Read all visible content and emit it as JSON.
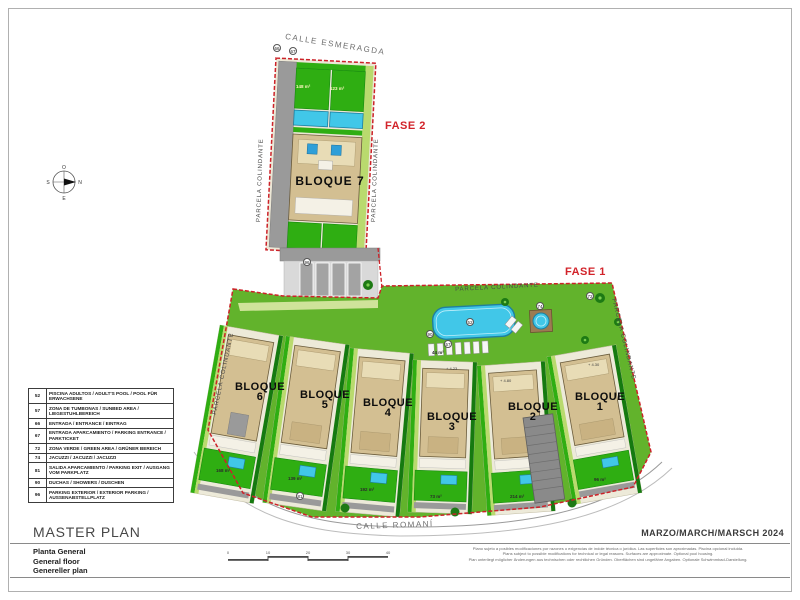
{
  "plan": {
    "streets": {
      "top": "CALLE ESMERAGDA",
      "bottom": "CALLE ROMANÍ"
    },
    "phases": {
      "fase1": "FASE 1",
      "fase2": "FASE 2"
    },
    "boundary_label": "PARCELA COLINDANTE",
    "compass": {
      "top": "O",
      "right": "N",
      "bottom": "E",
      "left": "S"
    },
    "bloques": {
      "b1": {
        "label": "BLOQUE",
        "num": "1"
      },
      "b2": {
        "label": "BLOQUE",
        "num": "2"
      },
      "b3": {
        "label": "BLOQUE",
        "num": "3"
      },
      "b4": {
        "label": "BLOQUE",
        "num": "4"
      },
      "b5": {
        "label": "BLOQUE",
        "num": "5"
      },
      "b6": {
        "label": "BLOQUE",
        "num": "6"
      },
      "b7": {
        "label": "BLOQUE 7"
      }
    },
    "areas": {
      "fase2_garden_left": "148 m²",
      "fase2_garden_right": "123 m²",
      "pool_terrace": "44 m²",
      "bloque6_garden": "168 m²",
      "bloque5_garden": "139 m²",
      "bloque4_garden": "192 m²",
      "bloque3_garden": "73 m²",
      "bloque2_garden": "214 m²",
      "bloque1_garden": "96 m²"
    },
    "levels": {
      "l1": "+ 4.23",
      "l2": "+ 4.80",
      "l3": "+ 4.30"
    },
    "markers": {
      "entrance": "66",
      "parking_entrance": "67",
      "exterior_parking": "96",
      "pool": "52",
      "sunbeds": "57",
      "showers": "90",
      "jacuzzi": "74",
      "green": "72",
      "parking_exit": "81"
    },
    "colors": {
      "boundary_red": "#cc2229",
      "lawn_green": "#62b32c",
      "garden_green": "#2fae12",
      "pool_blue": "#41c7e8",
      "building_beige": "#d3bf92"
    }
  },
  "legend": {
    "rows": [
      {
        "num": "52",
        "label": "PISCINA ADULTOS / ADULT'S POOL / POOL FÜR ERWACHSENE"
      },
      {
        "num": "57",
        "label": "ZONA DE TUMBONAS / SUNBED AREA / LIEGESTUHLBEREICH"
      },
      {
        "num": "66",
        "label": "ENTRADA / ENTRANCE / EINTRAG"
      },
      {
        "num": "67",
        "label": "ENTRADA APARCAMIENTO / PARKING ENTRANCE / PARKTICKET"
      },
      {
        "num": "72",
        "label": "ZONA VERDE / GREEN AREA / GRÜNER BEREICH"
      },
      {
        "num": "74",
        "label": "JACUZZI / JACUZZI / JACUZZI"
      },
      {
        "num": "81",
        "label": "SALIDA APARCAMIENTO / PARKING EXIT / AUSGANG VOM PARKPLATZ"
      },
      {
        "num": "90",
        "label": "DUCHAS / SHOWERS / DUSCHEN"
      },
      {
        "num": "96",
        "label": "PARKING EXTERIOR / EXTERIOR PARKING / AUSSENABSTELLPLATZ"
      }
    ]
  },
  "titleblock": {
    "title": "MASTER PLAN",
    "subtitles": [
      "Planta General",
      "General floor",
      "Genereller plan"
    ],
    "date": "MARZO/MARCH/MARSCH 2024",
    "disclaimer": [
      "Plano sujeto a posibles modificaciones por razones o exigencias de índole técnica o jurídica. Las superficies son aproximadas. Piscina opcional incluida.",
      "Plans subject to possible modifications for technical or legal reasons. Surfaces are approximate. Optional pool housing.",
      "Plan unterliegt möglicher Änderungen aus technischen oder rechtlichen Gründen. Oberflächen sind ungefähre Angaben. Optionale Schwimmbad-Darstellung."
    ]
  },
  "scalebar": {
    "ticks": [
      "0",
      "10",
      "20",
      "30",
      "40"
    ]
  }
}
